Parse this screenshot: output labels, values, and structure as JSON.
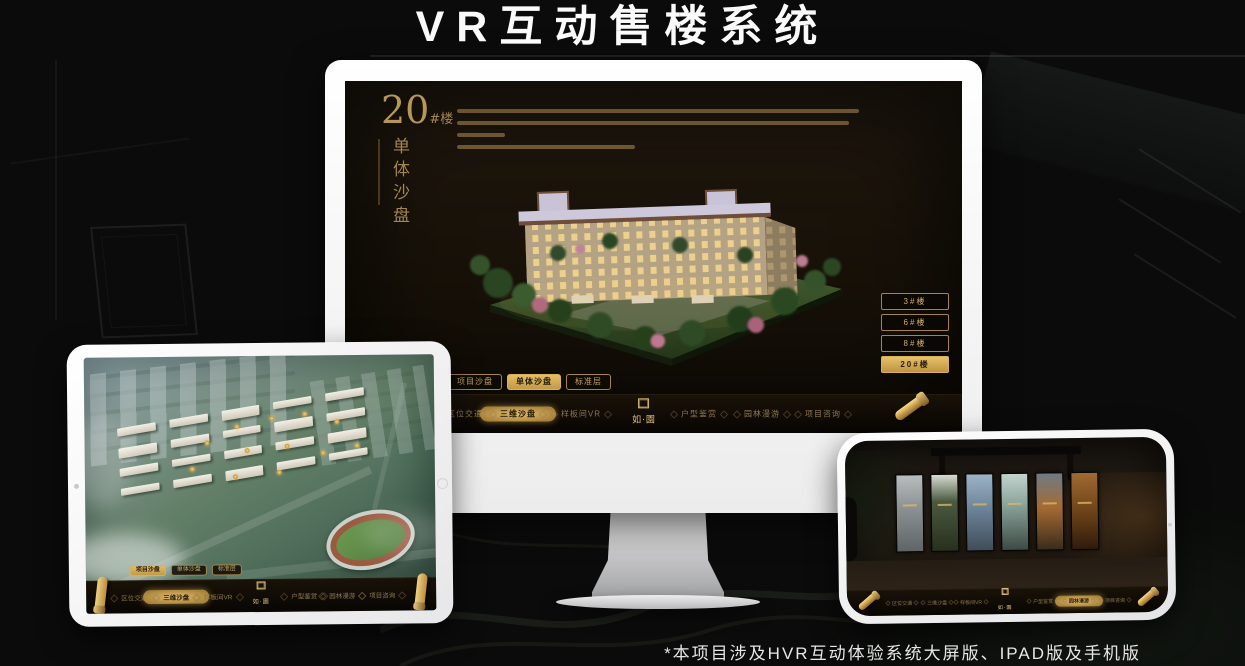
{
  "page": {
    "title": "VR互动售楼系统",
    "footnote": "*本项目涉及HVR互动体验系统大屏版、IPAD版及手机版"
  },
  "app": {
    "brand": {
      "logo_text": "如·園"
    },
    "view_tabs": [
      {
        "label": "项目沙盘"
      },
      {
        "label": "单体沙盘"
      },
      {
        "label": "标准层"
      }
    ],
    "nav_items": [
      {
        "label": "区位交通"
      },
      {
        "label": "三维沙盘"
      },
      {
        "label": "样板间VR"
      },
      {
        "label": "户型鉴赏"
      },
      {
        "label": "园林漫游"
      },
      {
        "label": "项目咨询"
      }
    ]
  },
  "monitor": {
    "heading": {
      "number": "20",
      "suffix": "#楼",
      "subtitle": "单体沙盘"
    },
    "floor_buttons": [
      {
        "label": "3#楼",
        "active": false
      },
      {
        "label": "6#楼",
        "active": false
      },
      {
        "label": "8#楼",
        "active": false
      },
      {
        "label": "20#楼",
        "active": true
      }
    ],
    "active_tab": "单体沙盘",
    "active_nav": "三维沙盘"
  },
  "tablet": {
    "active_tab": "项目沙盘",
    "active_nav": "三维沙盘"
  },
  "phone": {
    "active_nav": "园林漫游"
  },
  "colors": {
    "accent_gold": "#c9a254",
    "gold_dark": "#8a6d3b",
    "screen_bg": "#17110b",
    "canvas_bg": "#0a0b0a"
  }
}
